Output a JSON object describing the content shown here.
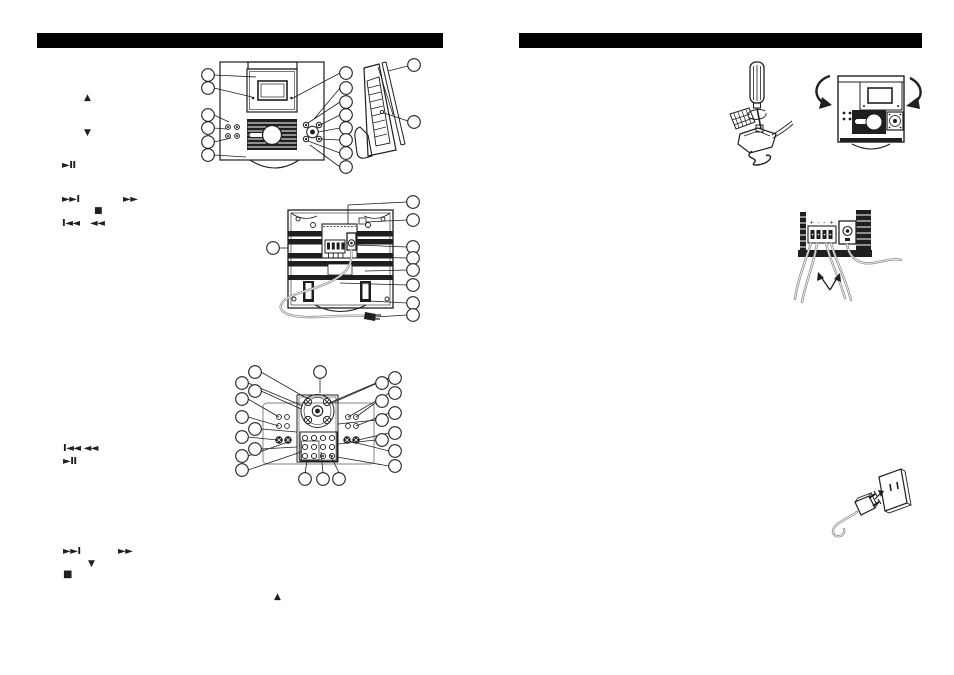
{
  "canvas": {
    "width": 954,
    "height": 675,
    "bg": "#ffffff",
    "ink": "#1f1f1f",
    "cord_gray": "#8f8f8f",
    "header_bar_color": "#000000"
  },
  "headers": {
    "left_label": "",
    "right_label": ""
  },
  "symbols": [
    {
      "name": "tune-up-arrow",
      "glyph": "▲"
    },
    {
      "name": "tune-down-arrow",
      "glyph": "▼"
    },
    {
      "name": "play-pause-symbol",
      "glyph": "►II"
    },
    {
      "name": "skip-next-symbol",
      "glyph": "►►I"
    },
    {
      "name": "fast-forward-symbol",
      "glyph": "►►"
    },
    {
      "name": "stop-symbol",
      "glyph": "■"
    },
    {
      "name": "skip-prev-symbol",
      "glyph": "I◄◄"
    },
    {
      "name": "rewind-symbol",
      "glyph": "◄◄"
    },
    {
      "name": "skip-prev-rewind-symbol",
      "glyph": "I◄◄ ◄◄"
    },
    {
      "name": "play-pause-symbol-2",
      "glyph": "►II"
    },
    {
      "name": "skip-next-symbol-2",
      "glyph": "►►I"
    },
    {
      "name": "fast-forward-symbol-2",
      "glyph": "►►"
    },
    {
      "name": "preset-down-arrow",
      "glyph": "▼"
    },
    {
      "name": "stop-symbol-2",
      "glyph": "■"
    },
    {
      "name": "eject-up-arrow",
      "glyph": "▲"
    }
  ],
  "figures": {
    "front_view": {
      "callouts_left": 6,
      "callouts_right": 8
    },
    "side_view": {
      "callouts": 2
    },
    "back_view": {
      "callouts_right": 8,
      "callouts_left": 1
    },
    "panel_view": {
      "callouts_top": 1,
      "callouts_left": 10,
      "callouts_right": 10,
      "callouts_bottom": 3
    },
    "terminals": {
      "marks": "+ - - +"
    }
  }
}
